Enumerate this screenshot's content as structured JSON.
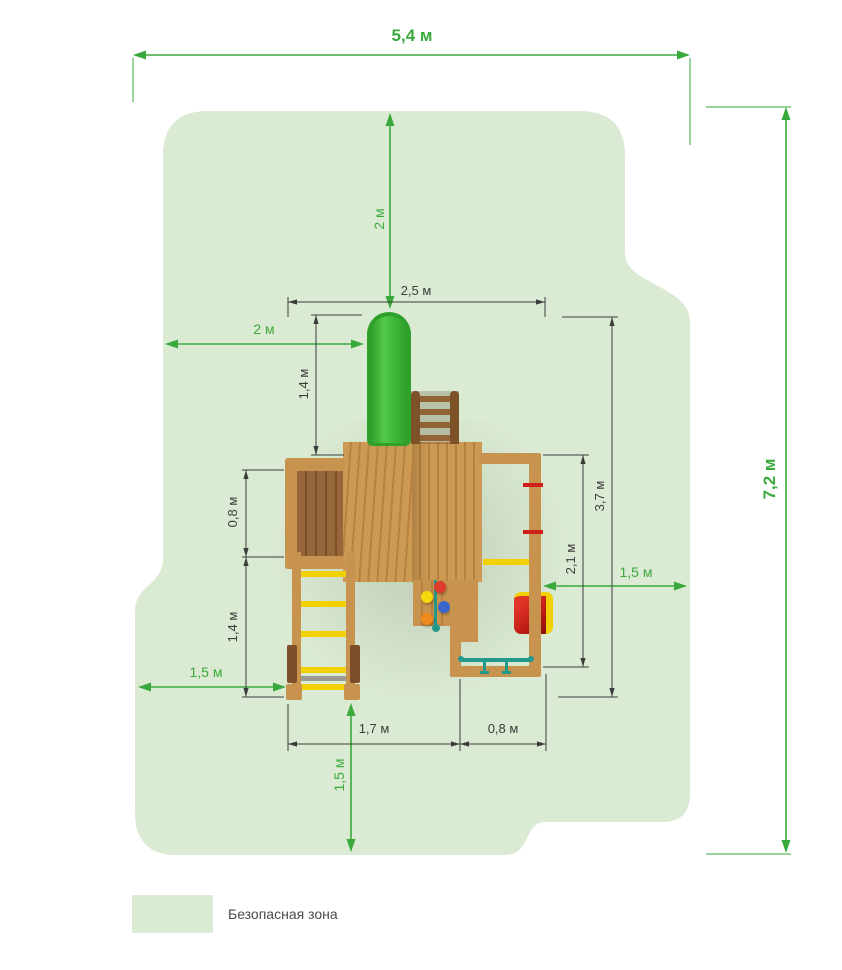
{
  "colors": {
    "zone": "#dbead2",
    "dim_green": "#3aa93c",
    "dim_dark": "#3c3c3c",
    "wood_light": "#cd9a54",
    "wood_stripe": "#b7823f",
    "wood_frame": "#c8934e",
    "wood_dark": "#96673a",
    "wood_dark_stripe": "#7e5129",
    "rail_dark": "#7d5229",
    "yellow": "#f1d103",
    "red": "#cf1f19",
    "teal": "#22998a",
    "slide_green": "#2ea12a",
    "legend_text": "#4a4a4a"
  },
  "dims": {
    "total_width": "5,4 м",
    "total_height": "7,2 м",
    "clearance_top": "2 м",
    "structure_width": "2,5 м",
    "clearance_left": "2 м",
    "slide_length": "1,4 м",
    "ramp_depth": "0,8 м",
    "ladder_length": "1,4 м",
    "clearance_left_bottom": "1,5 м",
    "clearance_right": "1,5 м",
    "swing_depth": "2,1 м",
    "structure_depth": "3,7 м",
    "clearance_bottom": "1,5 м",
    "footprint_left": "1,7 м",
    "footprint_right": "0,8 м"
  },
  "legend": {
    "label": "Безопасная зона"
  }
}
